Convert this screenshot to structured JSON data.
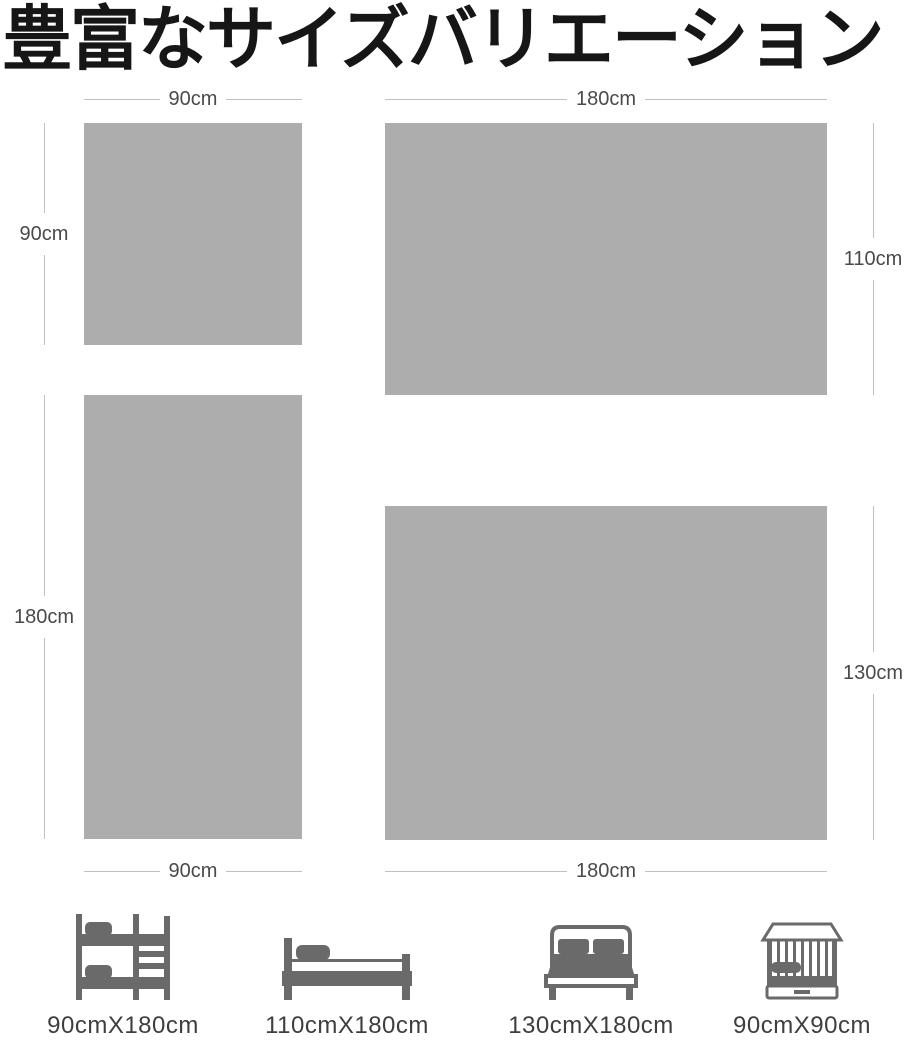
{
  "title": "豊富なサイズバリエーション",
  "panels": [
    {
      "name": "90x90cm",
      "width_label": "90cm",
      "height_label": "90cm"
    },
    {
      "name": "180x110cm",
      "width_label": "180cm",
      "height_label": "110cm"
    },
    {
      "name": "90x180cm",
      "width_label": "90cm",
      "height_label": "180cm"
    },
    {
      "name": "180x130cm",
      "width_label": "180cm",
      "height_label": "130cm"
    }
  ],
  "bed_types": [
    {
      "icon": "bunk-bed-icon",
      "label": "90cmX180cm"
    },
    {
      "icon": "single-bed-icon",
      "label": "110cmX180cm"
    },
    {
      "icon": "double-bed-icon",
      "label": "130cmX180cm"
    },
    {
      "icon": "crib-icon",
      "label": "90cmX90cm"
    }
  ],
  "colors": {
    "background": "#ffffff",
    "title_text": "#161616",
    "rect_fill": "#adadad",
    "dim_line": "#c0c0c0",
    "dim_text": "#4a4a4a",
    "label_text": "#3e3e3e",
    "icon": "#6a6a6a"
  }
}
